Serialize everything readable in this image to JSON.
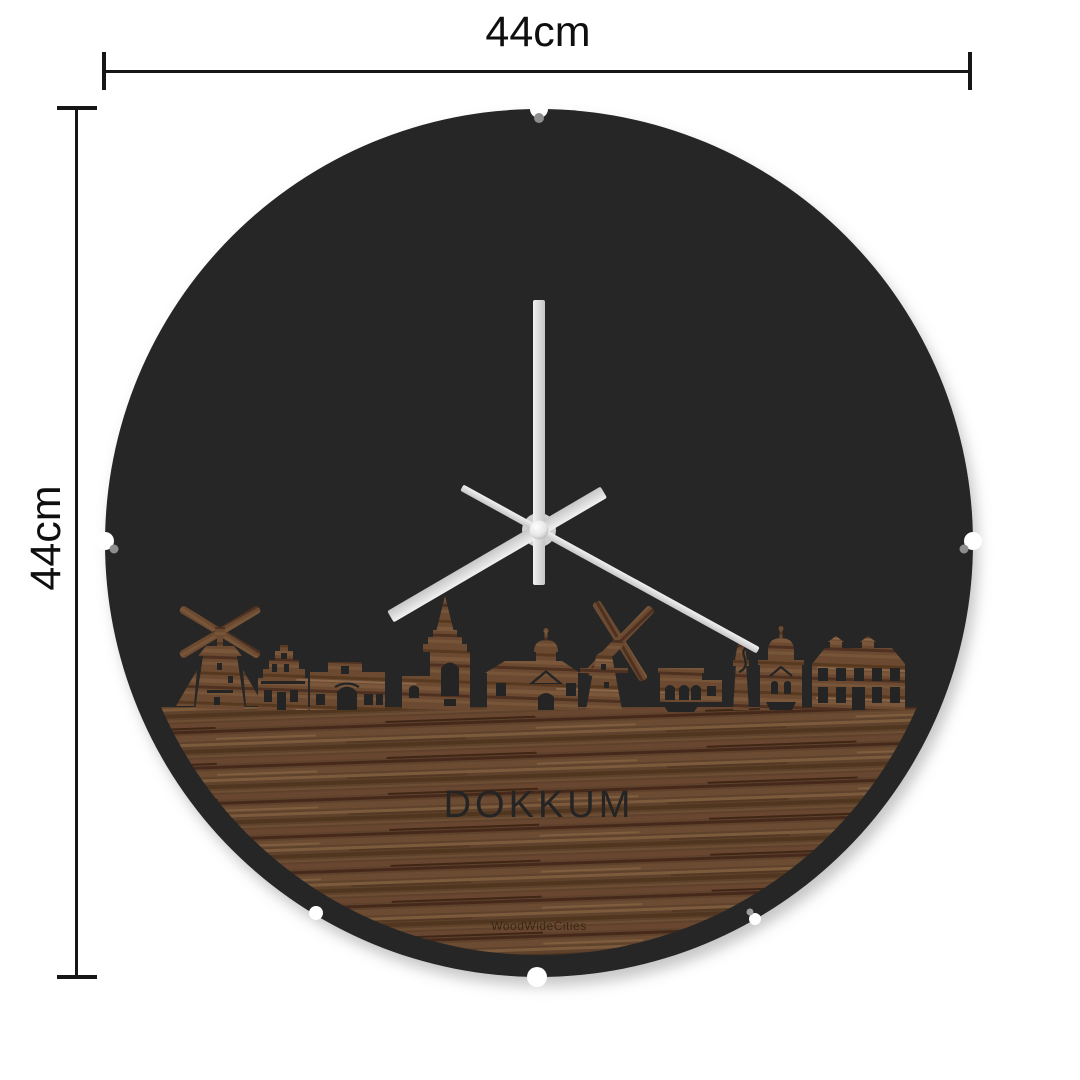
{
  "product_diagram": {
    "background": "#ffffff",
    "dimensions": {
      "width_label": "44cm",
      "height_label": "44cm"
    },
    "clock": {
      "city_label": "DOKKUM",
      "brand_watermark": "WoodWideCities",
      "colors": {
        "face": "#252525",
        "wood_base": "#5f422c",
        "wood_skyline": "#6b4a31",
        "wood_light": "#7c5a3c",
        "wood_dark": "#46291a",
        "hands": "#e0e0e0",
        "hub": "#d0d0d0"
      },
      "hands": {
        "hour_transform": "rotate(149.7 539 530)",
        "minute_transform": "rotate(-90 539 530)",
        "second_transform": "rotate(28.8 539 530)"
      }
    }
  }
}
